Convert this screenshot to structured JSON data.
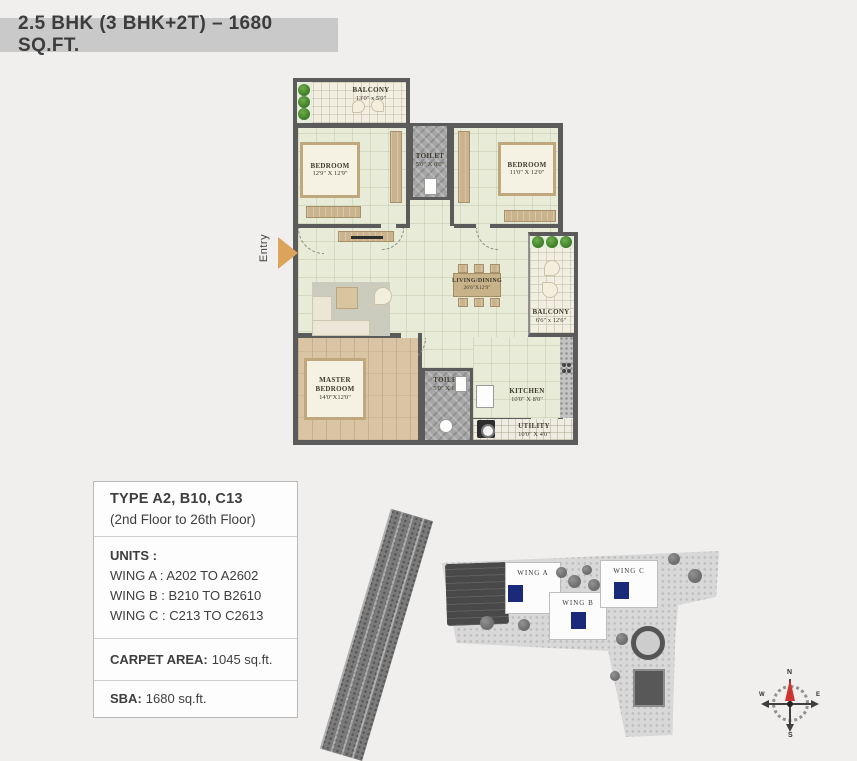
{
  "header": {
    "title": "2.5 BHK (3 BHK+2T) – 1680 SQ.FT."
  },
  "floor_plan": {
    "entry_label": "Entry",
    "rooms": {
      "balcony_top": {
        "name": "BALCONY",
        "dims": "13'0\" x 5'0\""
      },
      "bedroom_left": {
        "name": "BEDROOM",
        "dims": "12'9\" X 12'9\""
      },
      "toilet_top": {
        "name": "TOILET",
        "dims": "5'0\" X 8'0\""
      },
      "bedroom_right": {
        "name": "BEDROOM",
        "dims": "11'0\" X 12'0\""
      },
      "living_dining": {
        "name": "LIVING/DINING",
        "dims": "26'6\"X12'9\""
      },
      "balcony_right": {
        "name": "BALCONY",
        "dims": "6'6\" x 12'6\""
      },
      "master_bedroom": {
        "name": "MASTER BEDROOM",
        "dims": "14'0\"X12'0\""
      },
      "toilet_bottom": {
        "name": "TOILET",
        "dims": "5'0\" X 8'0\""
      },
      "kitchen": {
        "name": "KITCHEN",
        "dims": "10'0\" X 8'0\""
      },
      "utility": {
        "name": "UTILITY",
        "dims": "10'0\" X 4'0\""
      }
    },
    "colors": {
      "entry_arrow": "#dca45a",
      "wall": "#5b5b5b"
    }
  },
  "info_box": {
    "type_title": "TYPE A2, B10, C13",
    "floor_range": "(2nd Floor to 26th Floor)",
    "units_label": "UNITS :",
    "units": [
      "WING A : A202 TO A2602",
      "WING B : B210 TO B2610",
      "WING C : C213 TO C2613"
    ],
    "carpet_label": "CARPET AREA:",
    "carpet_value": "1045 sq.ft.",
    "sba_label": "SBA:",
    "sba_value": "1680 sq.ft."
  },
  "site_plan": {
    "wings": [
      "WING A",
      "WING B",
      "WING C"
    ],
    "highlight_color": "#1b2a78"
  },
  "compass": {
    "n": "N",
    "s": "S",
    "e": "E",
    "w": "W"
  }
}
